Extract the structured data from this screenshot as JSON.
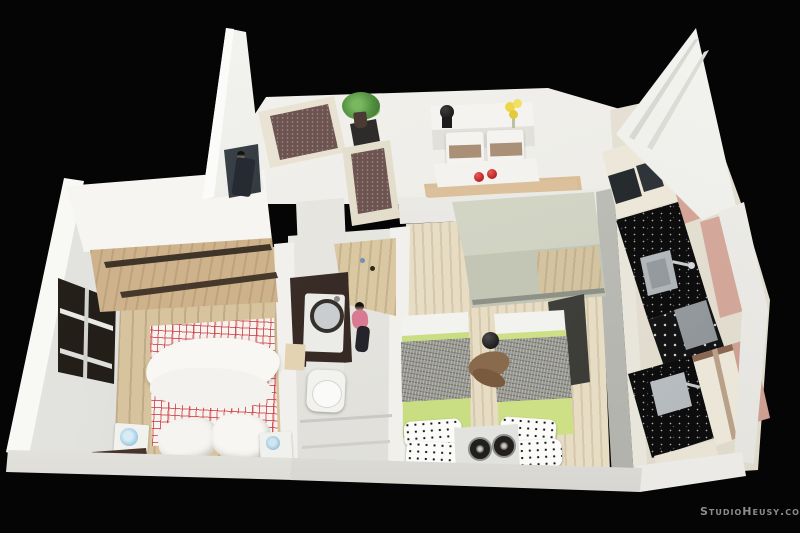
{
  "scene": {
    "type": "photograph-of-3d-architectural-scale-model",
    "description": "Top view of a miniature two-bedroom apartment model photographed on a black background",
    "background_color": "#050505"
  },
  "watermark": {
    "text": "StudioHeusy.com",
    "color": "#8c8c8c"
  },
  "rooms": [
    {
      "name": "living-room",
      "items": [
        "tv-wall",
        "tv-screen",
        "armchair",
        "side-table",
        "potted-plant",
        "sofa"
      ]
    },
    {
      "name": "dining-area",
      "items": [
        "sideboard",
        "black-vase",
        "yellow-flowers",
        "dining-chairs",
        "dining-table",
        "red-apples",
        "wood-bench"
      ]
    },
    {
      "name": "kitchen",
      "items": [
        "upper-cabinets",
        "built-in-appliances",
        "black-speckled-counter",
        "steel-sink",
        "gooseneck-faucet",
        "cooktop-burners",
        "steel-oven",
        "second-counter-sink",
        "dusty-rose-cabinets",
        "cream-cabinets"
      ]
    },
    {
      "name": "master-bedroom",
      "items": [
        "white-wardrobe",
        "sliding-door-rails",
        "window-with-blinds",
        "double-bed-red-plaid",
        "white-duvet",
        "pillows",
        "nightstand-with-blue-rose-left",
        "nightstand-with-blue-rose-right",
        "dark-wood-bench"
      ]
    },
    {
      "name": "bathroom",
      "items": [
        "dark-wood-vanity",
        "washing-machine",
        "toilet",
        "beige-storage-box",
        "wood-entry-floor"
      ]
    },
    {
      "name": "twin-bedroom",
      "items": [
        "sage-wardrobe",
        "twin-bed-left",
        "twin-bed-right",
        "green-sheets",
        "gray-knit-blankets",
        "polka-dot-pillows",
        "nightstand-with-two-fans",
        "teddy-bear",
        "dark-side-panel"
      ]
    }
  ],
  "figures": [
    "man-in-dark-suit-by-tv",
    "woman-pink-top-in-bathroom",
    "teddy-bear-between-twin-beds"
  ],
  "palette": {
    "background": "#050505",
    "wall_white": "#f2f1ed",
    "wood_floor": "#d7c49e",
    "plaid_red": "#cd3c46",
    "sheet_green": "#c9dd82",
    "blanket_gray": "#97978f",
    "sofa_brown": "#6d5450",
    "cabinet_pink": "#d9ab9e",
    "counter_black": "#0d0d0d",
    "vanity_brown": "#3a2a23",
    "apple_red": "#b51d20",
    "flower_yellow": "#eed64a"
  }
}
